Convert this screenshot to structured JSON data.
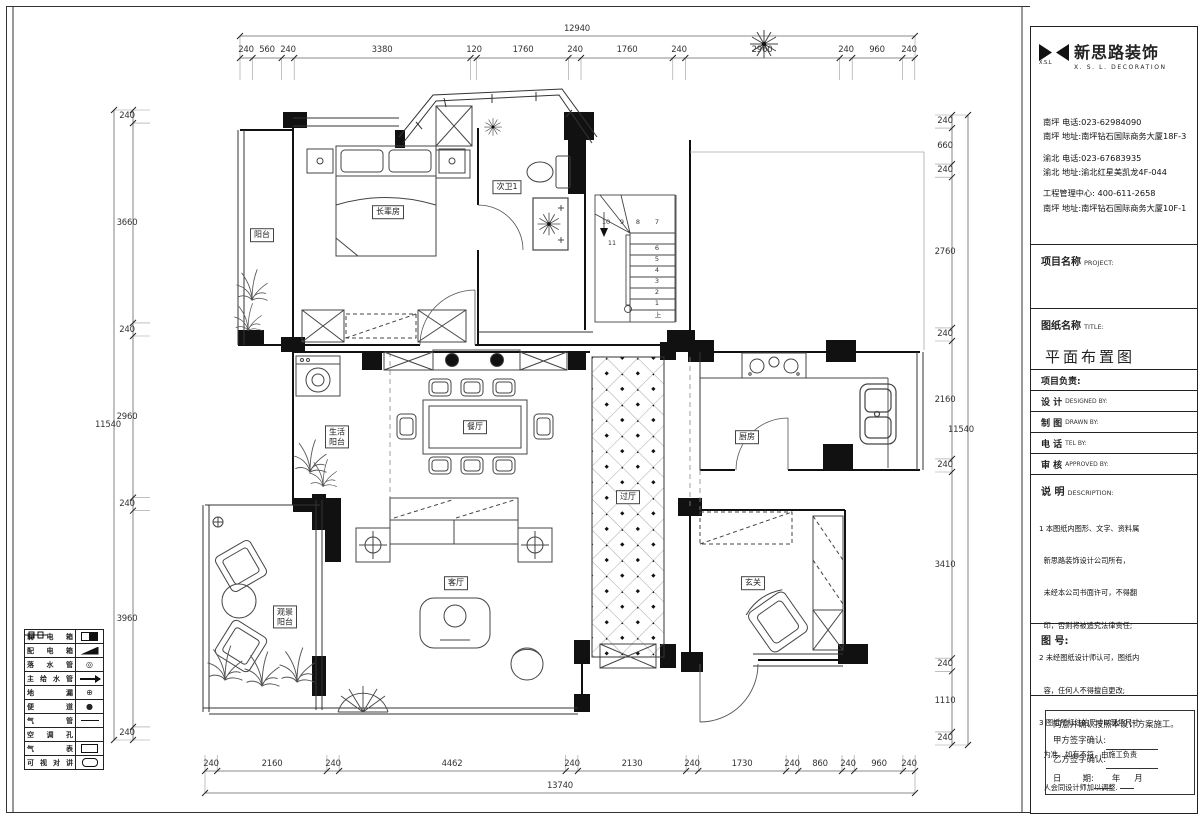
{
  "company": {
    "mark": "X.S.L",
    "name_cn": "新思路装饰",
    "name_en": "X. S. L. DECORATION",
    "contacts": [
      "南坪  电话:023-62984090",
      "南坪  地址:南坪钻石国际商务大厦18F-3",
      "渝北  电话:023-67683935",
      "渝北  地址:渝北红星美凯龙4F-044",
      "工程管理中心: 400-611-2658",
      "南坪  地址:南坪钻石国际商务大厦10F-1"
    ]
  },
  "titleblock": {
    "project_cn": "项目名称",
    "project_en": "PROJECT:",
    "sheet_cn": "图纸名称",
    "sheet_en": "TITLE:",
    "sheet_name": "平面布置图",
    "lead": "项目负责:",
    "design_cn": "设  计",
    "design_en": "DESIGNED BY:",
    "draw_cn": "制  图",
    "draw_en": "DRAWN BY:",
    "tel_cn": "电  话",
    "tel_en": "TEL BY:",
    "approve_cn": "审  核",
    "approve_en": "APPROVED BY:",
    "desc_cn": "说  明",
    "desc_en": "DESCRIPTION:",
    "notes": [
      "1 本图纸内图形、文字、资料属",
      "  新思路装饰设计公司所有，",
      "  未经本公司书面许可，不得翻",
      "  印，否则将被追究法律责任;",
      "2 未经图纸设计师认可，图纸内",
      "  容，任何人不得擅自更改;",
      "3 图纸所标注的尺寸以现场尺寸",
      "  为准，如有不符，由施工负责",
      "  人会同设计师加以调整."
    ],
    "fig_no": "图 号:",
    "sign": {
      "agree": "同意并确认按照本设计方案施工。",
      "party_a": "甲方签字确认:",
      "party_b": "乙方签字确认:",
      "date_label": "日        期:",
      "year": "年",
      "month": "月"
    }
  },
  "legend": {
    "items": [
      {
        "label": "弱电箱"
      },
      {
        "label": "配电箱"
      },
      {
        "label": "落水管",
        "glyph": "◎"
      },
      {
        "label": "主给水管"
      },
      {
        "label": "地漏",
        "glyph": "⊕"
      },
      {
        "label": "便道",
        "glyph": "●"
      },
      {
        "label": "气管"
      },
      {
        "label": "空调孔"
      },
      {
        "label": "气表"
      },
      {
        "label": "可视对讲"
      }
    ]
  },
  "rooms": {
    "balcony": "阳台",
    "elder_room": "长辈房",
    "bath2": "次卫1",
    "life1": "生活",
    "life2": "阳台",
    "dining": "餐厅",
    "hall": "过厅",
    "kitchen": "厨房",
    "living": "客厅",
    "view1": "观景",
    "view2": "阳台",
    "entry": "玄关"
  },
  "stairs": {
    "up": "上",
    "numbers": [
      "1",
      "2",
      "3",
      "4",
      "5",
      "6",
      "7",
      "8",
      "9",
      "10",
      "11"
    ]
  },
  "dims": {
    "top": {
      "total": "12940",
      "segments": [
        "240",
        "560",
        "240",
        "3380",
        "120",
        "1760",
        "240",
        "1760",
        "240",
        "2960",
        "240",
        "960",
        "240"
      ]
    },
    "bottom": {
      "total": "13740",
      "segments": [
        "240",
        "2160",
        "240",
        "4462",
        "240",
        "2130",
        "240",
        "1730",
        "240",
        "860",
        "240",
        "960",
        "240"
      ]
    },
    "left": {
      "total": "11540",
      "segments": [
        "240",
        "3660",
        "240",
        "2960",
        "240",
        "3960",
        "240"
      ]
    },
    "right": {
      "total": "11540",
      "segments": [
        "240",
        "660",
        "240",
        "2760",
        "240",
        "2160",
        "240",
        "3410",
        "240",
        "1110",
        "240"
      ]
    }
  }
}
